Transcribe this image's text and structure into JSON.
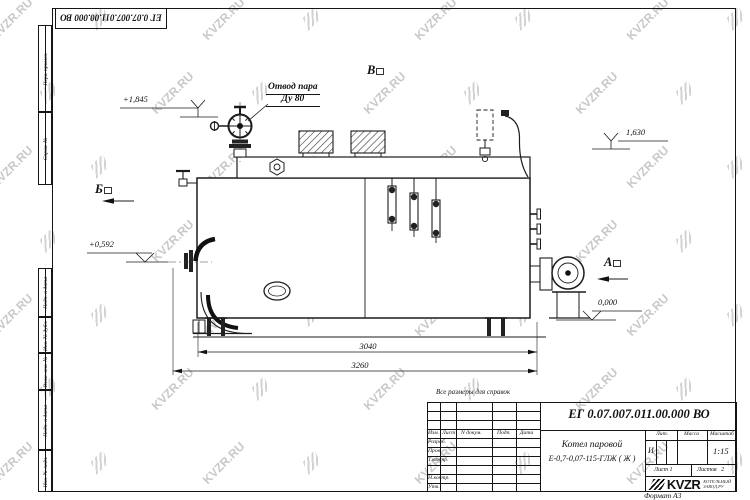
{
  "sheet": {
    "note": "Все размеры для справок",
    "format": "Формат А3"
  },
  "watermark": {
    "text": "KVZR.RU"
  },
  "doc": {
    "number": "ЕГ 0.07.007.011.00.000  ВО"
  },
  "margin": {
    "top": [
      "Перв. примен.",
      "Справ. №"
    ],
    "bottom": [
      "Подп. и дата",
      "Инв. № дубл.",
      "Взам. инв. №",
      "Подп. и дата",
      "Инв. № подл."
    ]
  },
  "callout": {
    "line1": "Отвод пара",
    "line2": "Ду 80"
  },
  "views": {
    "left": "Б",
    "top": "В",
    "right": "А"
  },
  "levels": {
    "l1": "+1,845",
    "l2": "1,630",
    "l3": "+0,592",
    "l4": "0,000"
  },
  "dims": {
    "inner": "3040",
    "outer": "3260"
  },
  "titleblock": {
    "header": {
      "izm": "Изм.",
      "list": "Лист",
      "ndoc": "N докум.",
      "podp": "Подп.",
      "data": "Дата"
    },
    "rows": [
      "Разраб.",
      "Пров.",
      "Т.контр.",
      "",
      "Н.контр.",
      "Утв."
    ],
    "product": {
      "line1": "Котел паровой",
      "line2": "Е-0,7-0,07-115-ГЛЖ ( Ж )"
    },
    "lit_label": "Лит.",
    "lit": "И",
    "mass_label": "Масса",
    "scale_label": "Масштаб",
    "scale": "1:15",
    "sheet": "Лист 1",
    "sheets": "Листов   2",
    "brand": "KVZR",
    "brand_sub1": "КОТЕЛЬНЫЙ",
    "brand_sub2": "ЗАВОД.РУ"
  }
}
